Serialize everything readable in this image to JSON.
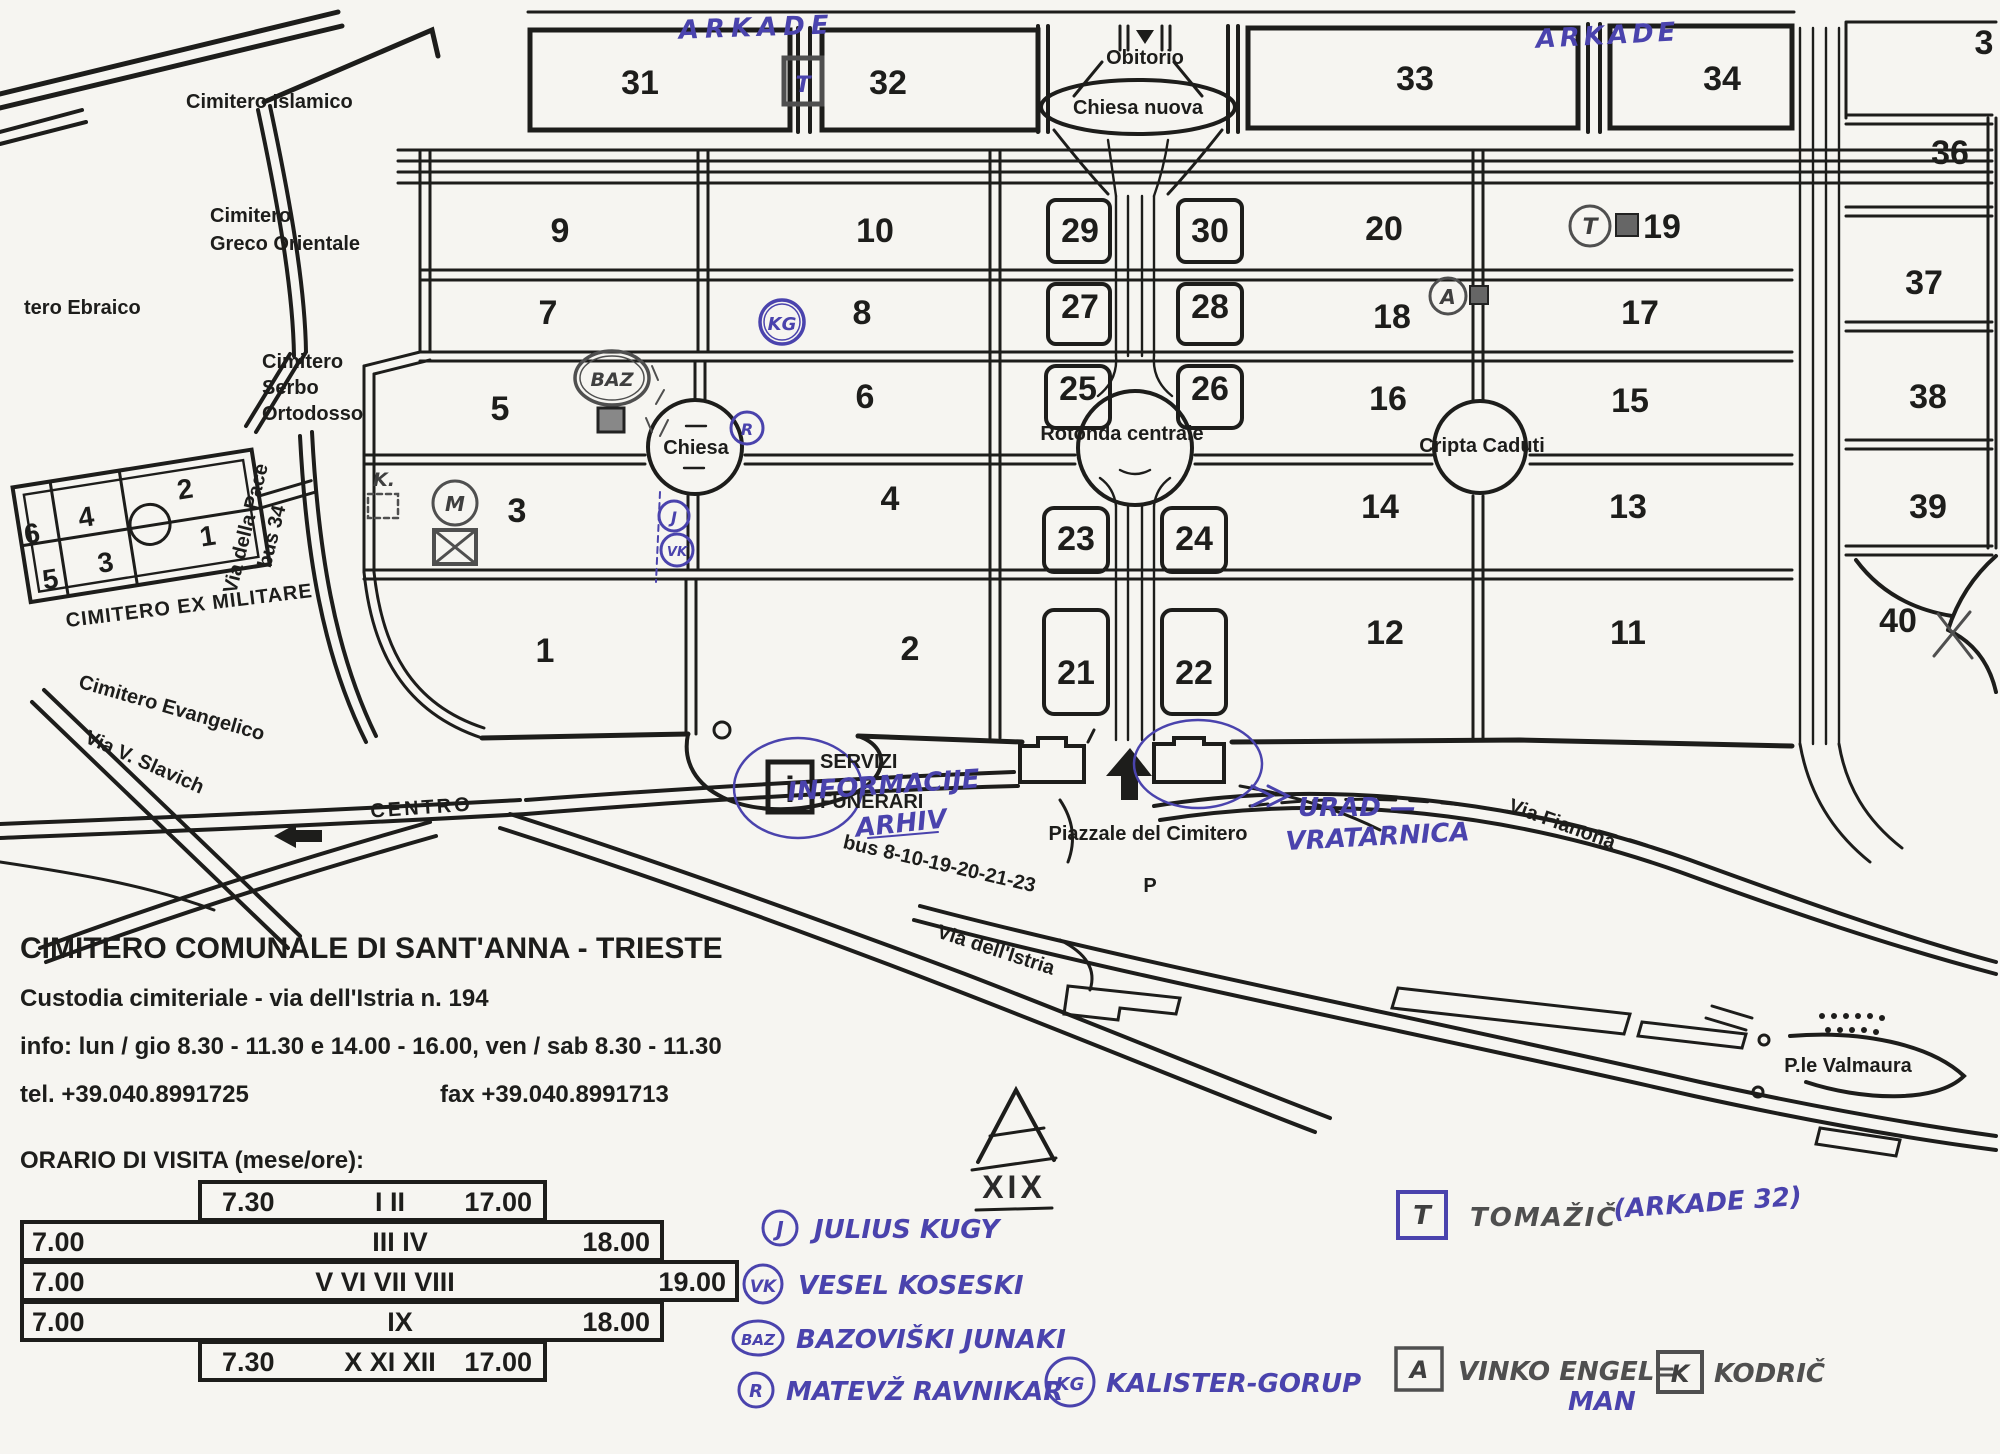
{
  "map": {
    "blocks": {
      "1": "1",
      "2": "2",
      "3": "3",
      "4": "4",
      "5": "5",
      "6": "6",
      "7": "7",
      "8": "8",
      "9": "9",
      "10": "10",
      "11": "11",
      "12": "12",
      "13": "13",
      "14": "14",
      "15": "15",
      "16": "16",
      "17": "17",
      "18": "18",
      "19": "19",
      "20": "20",
      "21": "21",
      "22": "22",
      "23": "23",
      "24": "24",
      "25": "25",
      "26": "26",
      "27": "27",
      "28": "28",
      "29": "29",
      "30": "30",
      "31": "31",
      "32": "32",
      "33": "33",
      "34": "34",
      "36": "36",
      "37": "37",
      "38": "38",
      "39": "39",
      "40": "40"
    },
    "block35_partial": "3",
    "areas": {
      "islamico": "Cimitero Islamico",
      "greco1": "Cimitero",
      "greco2": "Greco Orientale",
      "ebraico": "tero Ebraico",
      "serbo1": "Cimitero",
      "serbo2": "Serbo",
      "serbo3": "Ortodosso",
      "ex_militare": "CIMITERO EX MILITARE",
      "evangelico": "Cimitero Evangelico"
    },
    "streets": {
      "slavich": "Via V. Slavich",
      "pace": "Via della Pace",
      "bus34": "bus 34",
      "centro": "CENTRO",
      "istria": "Via dell'Istria",
      "bus_linee": "bus 8-10-19-20-21-23",
      "fianona": "Via Fianona",
      "valmaura": "P.le Valmaura",
      "piazzale": "Piazzale del Cimitero",
      "parking": "P"
    },
    "landmarks": {
      "obitorio": "Obitorio",
      "chiesa_nuova": "Chiesa nuova",
      "chiesa": "Chiesa",
      "rotonda": "Rotonda centrale",
      "cripta": "Cripta Caduti",
      "servizi1": "SERVIZI",
      "servizi2": "FUNERARI",
      "info_i": "i",
      "xix": "XIX"
    }
  },
  "annotations": {
    "arkade_left": "ARKADE",
    "arkade_right": "ARKADE",
    "informacije": "INFORMACIJE",
    "arhiv": "ARHIV",
    "urad": "URAD —",
    "vratarnica": "VRATARNICA",
    "k_dot": "K.",
    "m_mark": "M",
    "markers": [
      {
        "sym": "J",
        "name": "JULIUS KUGY"
      },
      {
        "sym": "VK",
        "name": "VESEL KOSESKI"
      },
      {
        "sym": "BAZ",
        "name": "BAZOVIŠKI JUNAKI"
      },
      {
        "sym": "R",
        "name": "MATEVŽ RAVNIKAR"
      },
      {
        "sym": "KG",
        "name": "KALISTER-GORUP"
      }
    ],
    "legend_right": [
      {
        "sym": "T",
        "name": "TOMAŽIČ",
        "note": "(ARKADE 32)"
      },
      {
        "sym": "A",
        "name": "VINKO ENGEL=",
        "note2": "MAN"
      },
      {
        "sym": "K",
        "name": "KODRIČ"
      }
    ]
  },
  "info_block": {
    "title": "CIMITERO COMUNALE DI SANT'ANNA - TRIESTE",
    "custodia": "Custodia cimiteriale - via dell'Istria n. 194",
    "info_line": "info:  lun / gio  8.30 - 11.30  e  14.00  - 16.00,  ven / sab  8.30 - 11.30",
    "tel": "tel. +39.040.8991725",
    "fax": "fax +39.040.8991713",
    "orario": "ORARIO DI VISITA (mese/ore):"
  },
  "orario_rows": [
    {
      "open": "7.30",
      "months": "I  II",
      "close": "17.00"
    },
    {
      "open": "7.00",
      "months": "III  IV",
      "close": "18.00"
    },
    {
      "open": "7.00",
      "months": "V  VI  VII  VIII",
      "close": "19.00"
    },
    {
      "open": "7.00",
      "months": "IX",
      "close": "18.00"
    },
    {
      "open": "7.30",
      "months": "X  XI  XII",
      "close": "17.00"
    }
  ]
}
